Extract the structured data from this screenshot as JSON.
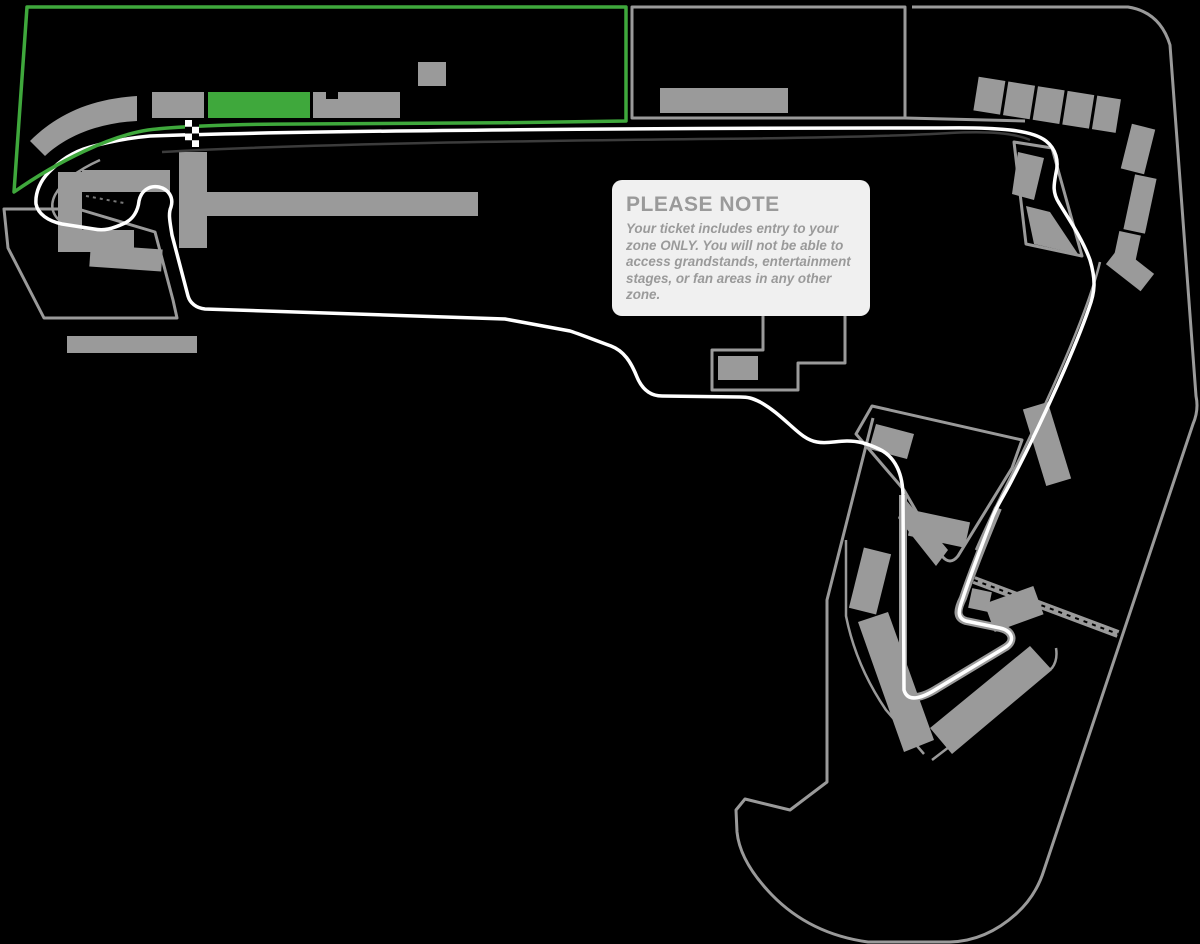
{
  "note": {
    "title": "PLEASE NOTE",
    "body": "Your ticket includes entry to your zone ONLY. You will not be able to access grandstands, entertainment stages, or fan areas in any other zone."
  },
  "map": {
    "type": "circuit-zone-map",
    "highlighted_zone": "green",
    "start_finish_marker": "checkered-flag"
  },
  "colors": {
    "background": "#000000",
    "zone_outline": "#9a9a9a",
    "grandstand": "#9a9a9a",
    "track": "#ffffff",
    "pit_lane": "#3c3c3c",
    "highlight_green": "#3fa83c",
    "note_bg": "#f0f0f0",
    "note_text": "#9a9a9a"
  }
}
